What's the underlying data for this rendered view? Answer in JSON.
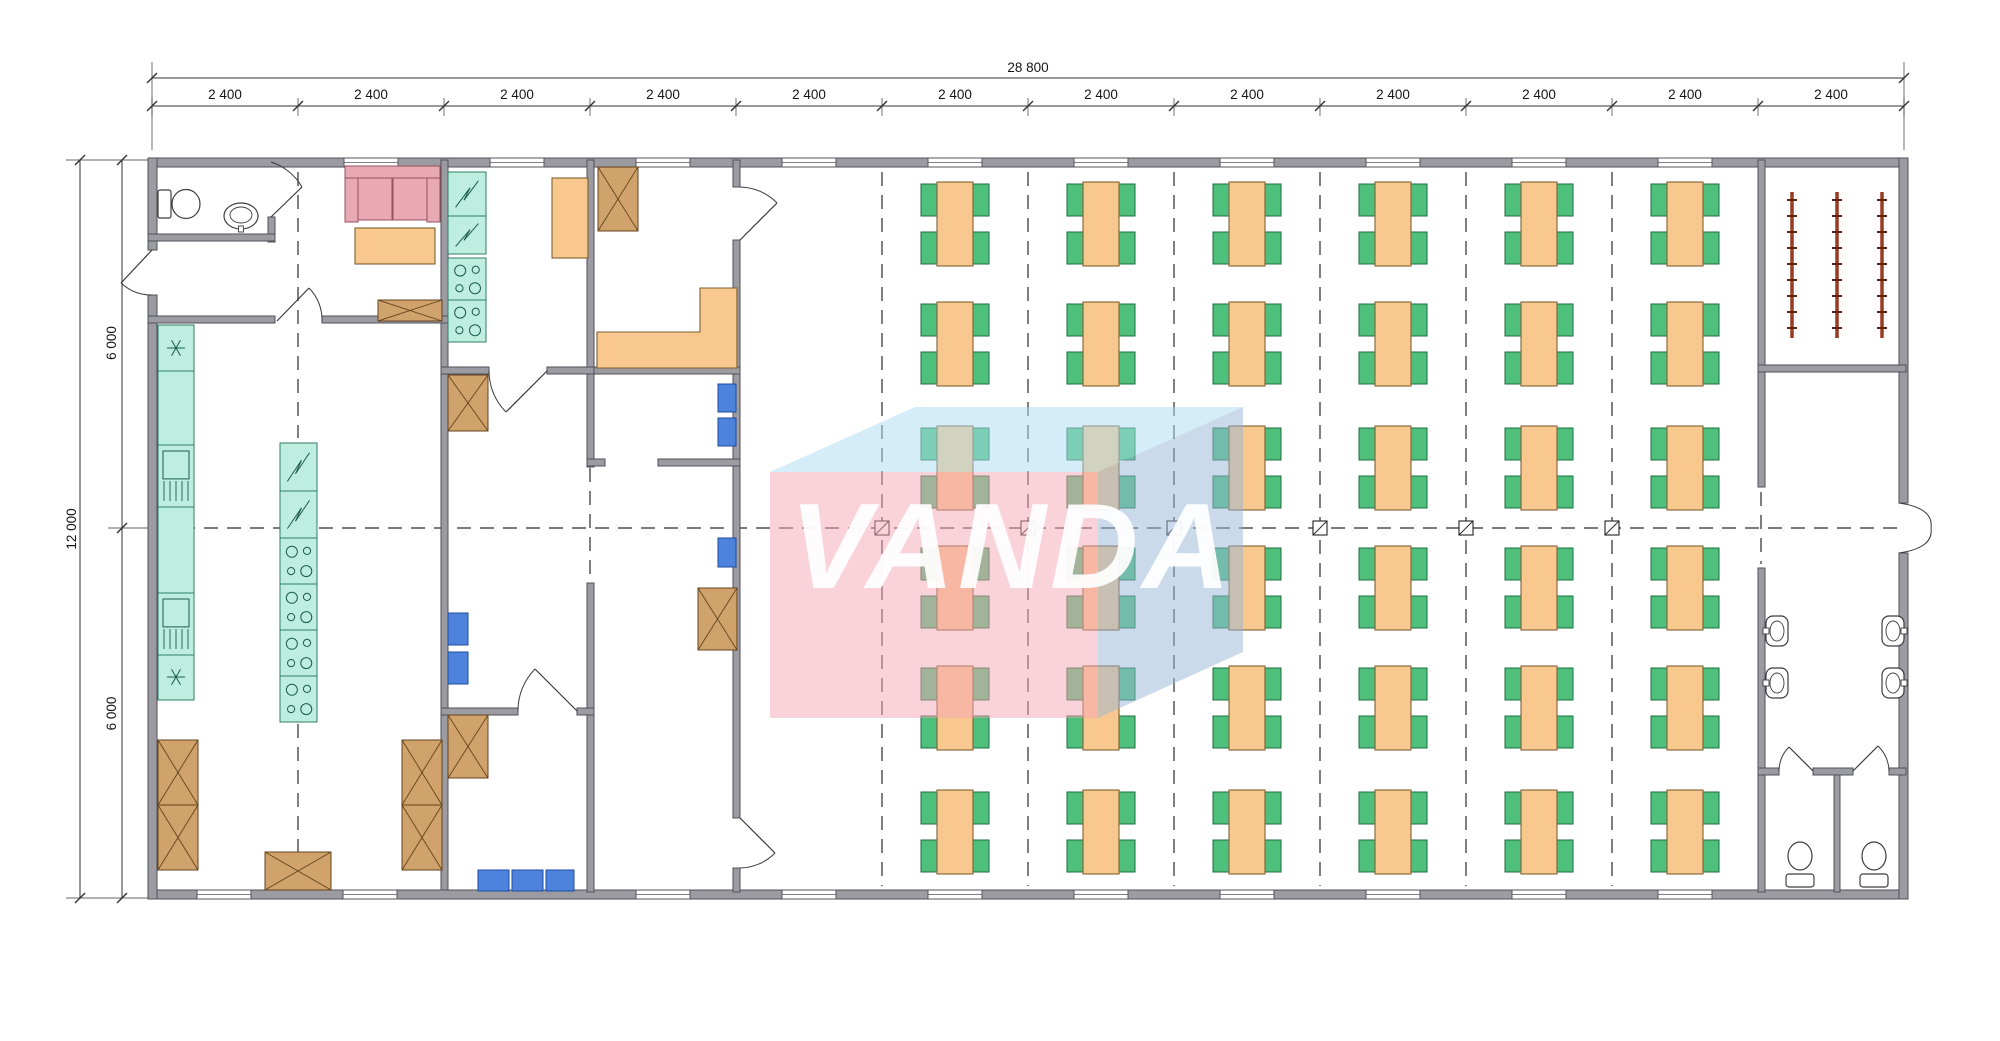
{
  "title": "Floor plan 28800 x 12000 canteen module building",
  "watermark": {
    "text": "VANDA"
  },
  "dimensions": {
    "total_width": "28 800",
    "total_height": "12 000",
    "module_width": "2 400",
    "modules": [
      "2 400",
      "2 400",
      "2 400",
      "2 400",
      "2 400",
      "2 400",
      "2 400",
      "2 400",
      "2 400",
      "2 400",
      "2 400",
      "2 400"
    ],
    "halves": [
      "6 000",
      "6 000"
    ]
  },
  "dining": {
    "rows": 6,
    "cols": 6,
    "tables": 36,
    "chairs_per_table": 4
  },
  "cloakroom": {
    "racks": 3
  },
  "washroom": {
    "basins": 4,
    "toilets": 2
  },
  "kitchen": {
    "wall_counter_units": 2,
    "island_fridges": 2,
    "island_stoves": 4,
    "room_fridges": 2,
    "room_stoves": 2
  },
  "lounge": {
    "sofa_seats": 2
  },
  "colors": {
    "wall": "#9b9ba1",
    "wall_edge": "#50505a",
    "table_orange": "#f8c88f",
    "table_edge": "#7c6133",
    "chair_green": "#4ec07c",
    "chair_edge": "#1c6e3e",
    "counter_teal": "#bdeee0",
    "counter_edge": "#2f7d63",
    "cabinet_brown": "#cfa36b",
    "cabinet_edge": "#66431c",
    "chair_blue": "#4d82dd",
    "chair_blue_edge": "#1d4d9e",
    "sofa_pink": "#e9a9b4",
    "sofa_edge": "#99505f",
    "rack_red": "#9c3b20",
    "line": "#333333",
    "wm_pink": "rgba(245,166,181,0.5)",
    "wm_top": "rgba(171,219,242,0.5)",
    "wm_side": "rgba(152,182,216,0.5)"
  }
}
